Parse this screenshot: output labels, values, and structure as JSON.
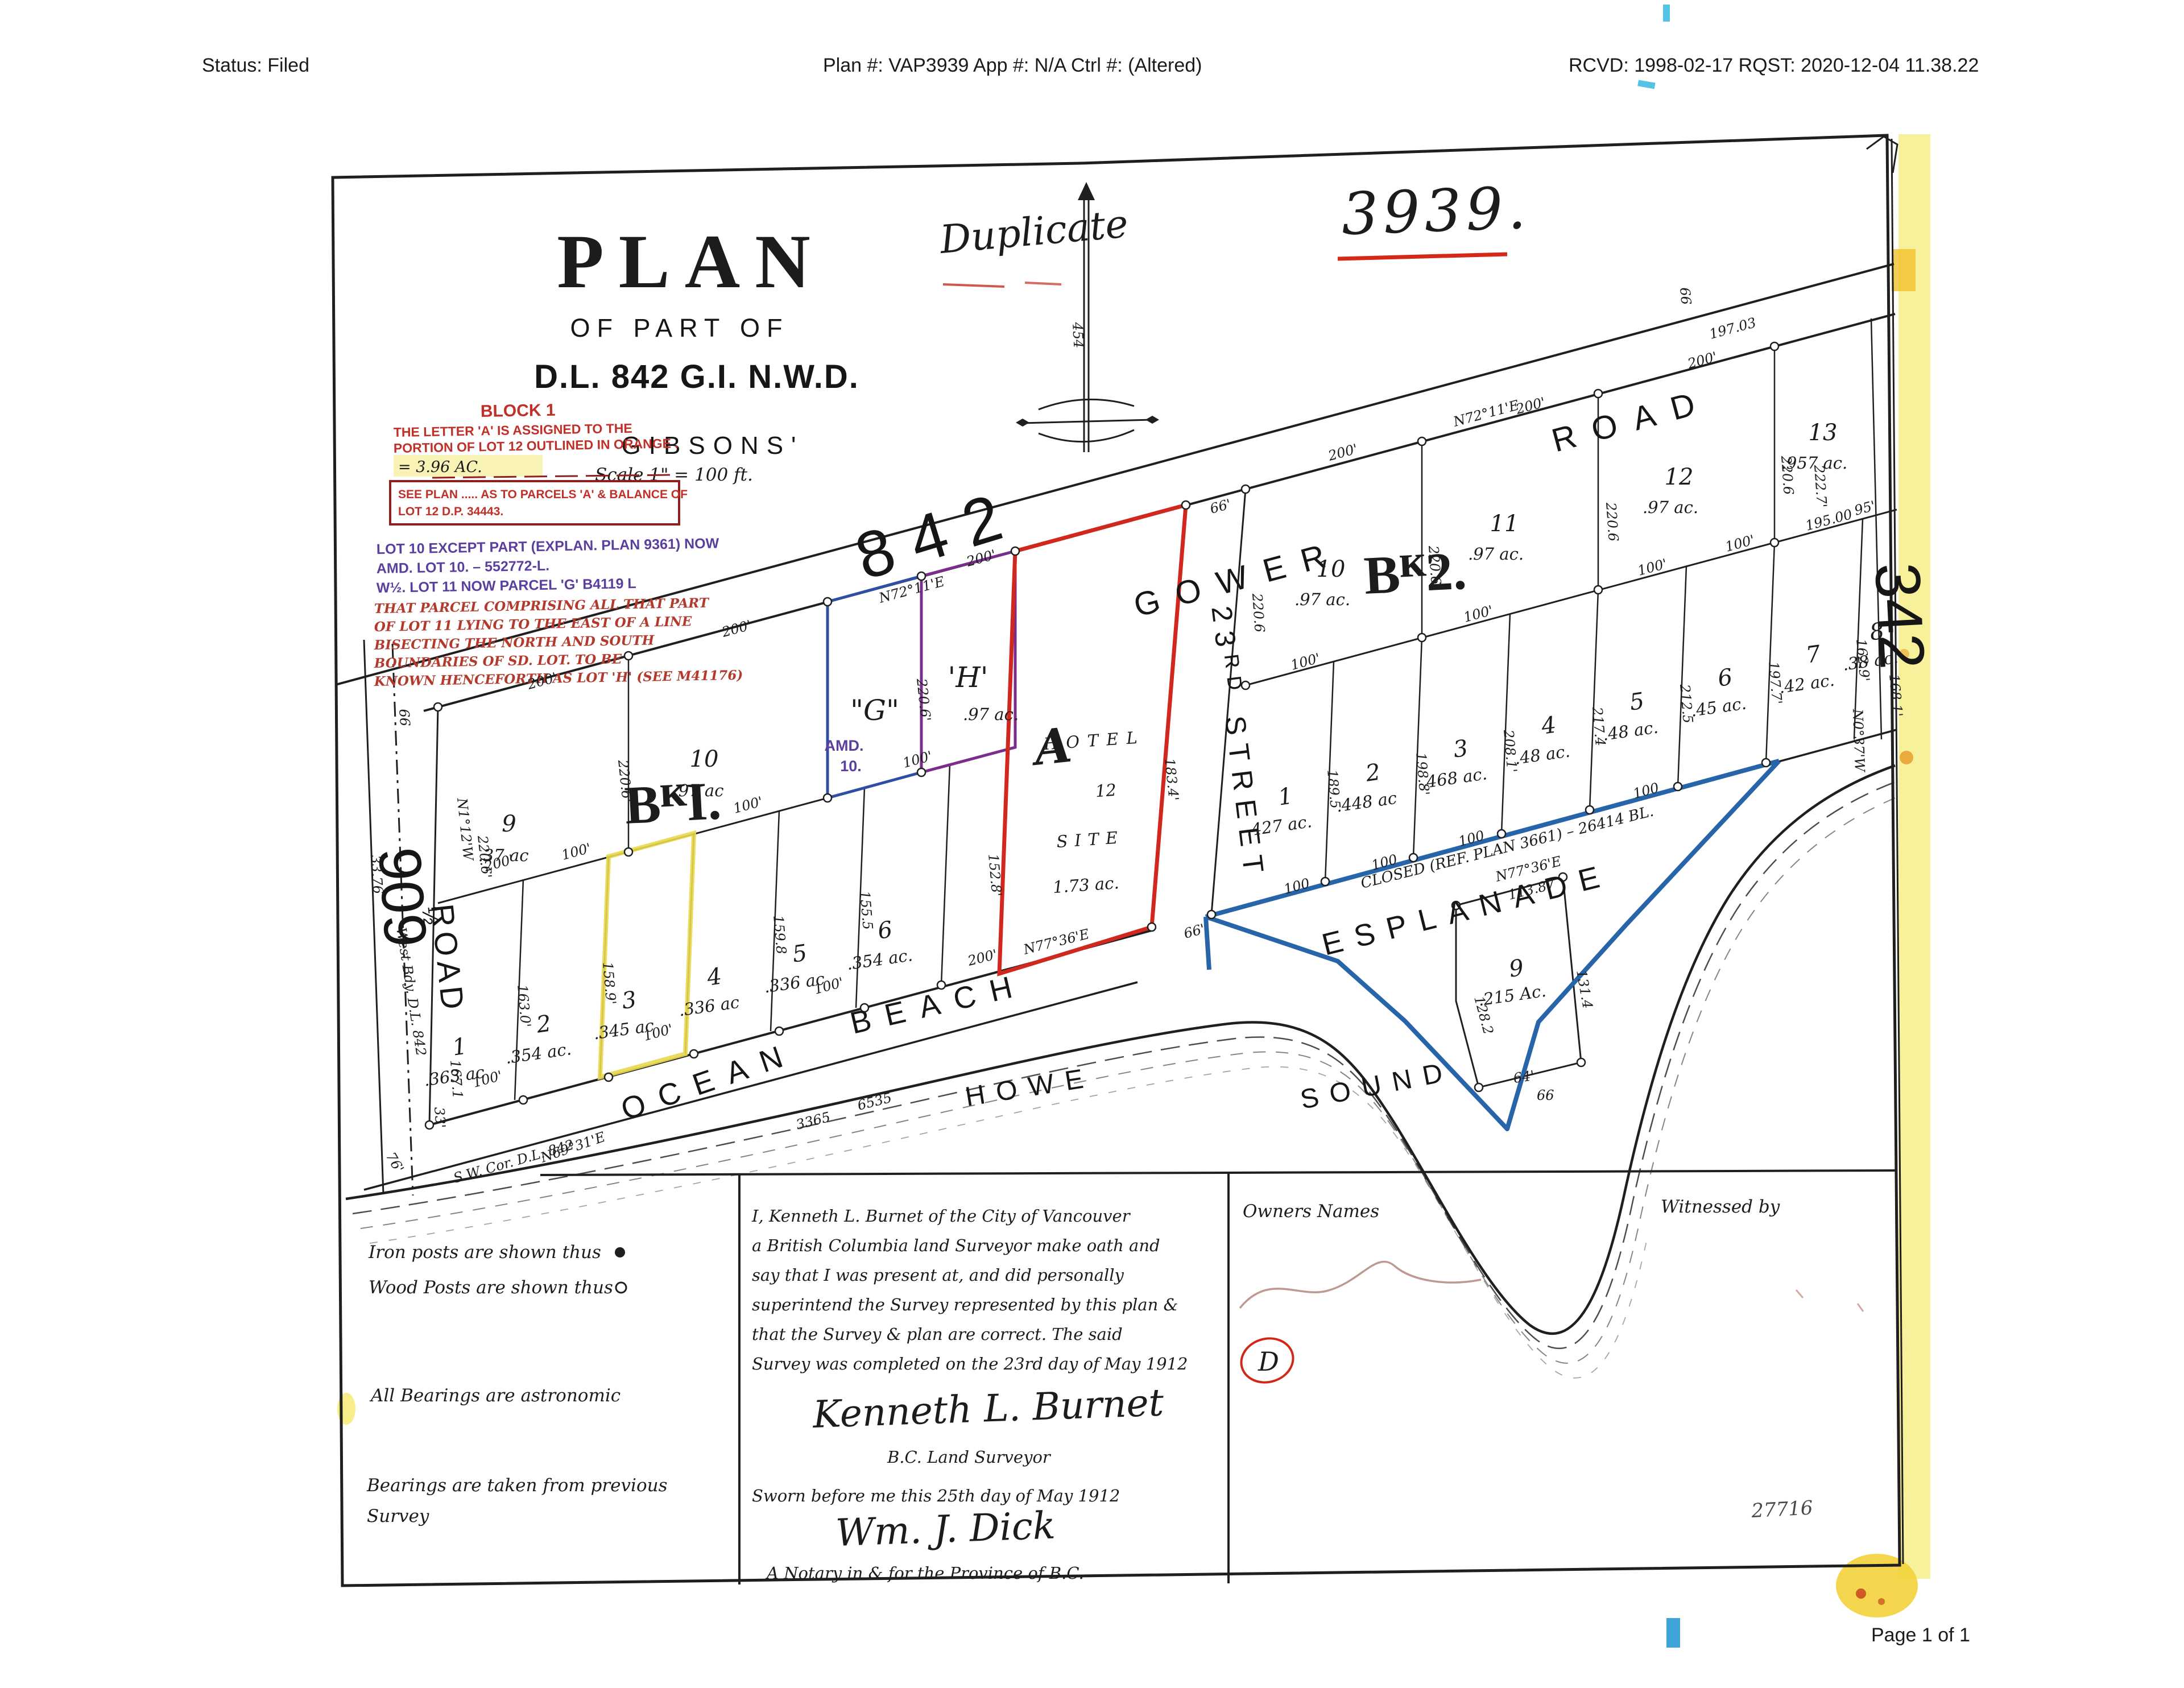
{
  "header": {
    "status": "Status: Filed",
    "plan": "Plan #: VAP3939 App #: N/A Ctrl #:  (Altered)",
    "rcvd": "RCVD: 1998-02-17 RQST: 2020-12-04 11.38.22"
  },
  "footer": {
    "page": "Page 1 of 1"
  },
  "stamps": {
    "duplicate": "Duplicate",
    "number": "3939."
  },
  "title": {
    "main": "PLAN",
    "sub": "OF PART OF",
    "district": "D.L. 842 G.I. N.W.D.",
    "place": "GIBSONS'",
    "scale": "Scale 1\" = 100 ft."
  },
  "annotations": {
    "block1_title": "BLOCK 1",
    "block1_line1": "THE LETTER 'A' IS ASSIGNED TO THE",
    "block1_line2": "PORTION OF LOT 12 OUTLINED IN ORANGE .",
    "highlight_line": "= 3.96 AC.",
    "box_line1": "SEE PLAN ..... AS TO PARCELS 'A' & BALANCE OF",
    "box_line2": "LOT 12     D.P. 34443.",
    "blue_line1": "LOT 10 EXCEPT PART (EXPLAN. PLAN 9361) NOW",
    "blue_line2": "AMD. LOT 10. – 552772-L.",
    "blue_line3": "W½. LOT 11 NOW PARCEL 'G'    B4119 L",
    "red_line1": "THAT PARCEL COMPRISING ALL THAT PART",
    "red_line2": "OF LOT 11 LYING TO THE EAST OF A LINE",
    "red_line3": "BISECTING THE NORTH AND SOUTH",
    "red_line4": "BOUNDARIES OF SD. LOT. TO BE",
    "red_line5": "KNOWN HENCEFORTH AS LOT 'H' (SEE M41176)"
  },
  "plan": {
    "blocks": {
      "b1": "BᴷI.",
      "b2": "Bᴷ2."
    },
    "streets": {
      "gower1": "GOWER",
      "gower2": "ROAD",
      "street23": "23ᴿᴰ STREET",
      "esplanade": "ESPLANADE",
      "ocean": "OCEAN",
      "beach": "BEACH",
      "howe": "HOWE",
      "sound": "SOUND",
      "r909": "909",
      "half": "½",
      "road909": "ROAD",
      "dl842": "842",
      "dl342": "342",
      "westbdy": "West Bdy. D.L. 842",
      "swcor": "S.W. Cor. D.L. 842"
    },
    "g": "\"G\"",
    "h": "'H'",
    "h_area": ".97 ac.",
    "amd1": "AMD.",
    "amd2": "10.",
    "closed_note": "CLOSED (REF. PLAN 3661) – 26414 BL.",
    "hotel": {
      "a": "A",
      "l1": "HOTEL",
      "l2": "12",
      "l3": "SITE",
      "l4": "1.73 ac."
    },
    "lot9w": {
      "num": "9",
      "area": ".215 Ac."
    },
    "b1_north": [
      {
        "num": "9",
        "area": ".37 ac"
      },
      {
        "num": "10",
        "area": ".97 ac"
      }
    ],
    "b1_south": [
      {
        "num": "1",
        "area": ".363 ac"
      },
      {
        "num": "2",
        "area": ".354 ac."
      },
      {
        "num": "3",
        "area": ".345 ac"
      },
      {
        "num": "4",
        "area": ".336 ac"
      },
      {
        "num": "5",
        "area": ".336 ac"
      },
      {
        "num": "6",
        "area": ".354 ac."
      }
    ],
    "b2_north": [
      {
        "num": "10",
        "area": ".97 ac."
      },
      {
        "num": "11",
        "area": ".97 ac."
      },
      {
        "num": "12",
        "area": ".97 ac."
      },
      {
        "num": "13",
        "area": ".957 ac."
      }
    ],
    "b2_south": [
      {
        "num": "1",
        "area": ".427 ac."
      },
      {
        "num": "2",
        "area": ".448 ac"
      },
      {
        "num": "3",
        "area": ".468 ac."
      },
      {
        "num": "4",
        "area": ".48 ac."
      },
      {
        "num": "5",
        "area": ".48 ac."
      },
      {
        "num": "6",
        "area": ".45 ac."
      },
      {
        "num": "7",
        "area": ".42 ac."
      },
      {
        "num": "8",
        "area": ".38 ac."
      }
    ],
    "dims": [
      "200'",
      "200'",
      "N72°11'E",
      "200'",
      "66'",
      "200'",
      "N72°11'E",
      "200'",
      "200'",
      "197.03",
      "66",
      "222.7'",
      "220.6",
      "220.6",
      "220.6",
      "220.6",
      "183.4'",
      "220.6'",
      "220.6'",
      "220.6'",
      "N1°12'W",
      "167.1",
      "33'",
      "100'",
      "100'",
      "200'",
      "100'",
      "163.0'",
      "158.9'",
      "159.8",
      "155.5",
      "152.8'",
      "100'",
      "100'",
      "100'",
      "N69°31'E",
      "3365",
      "6535",
      "N77°36'E",
      "200'",
      "66'",
      "100'",
      "100'",
      "100'",
      "100'",
      "195.00",
      "95'",
      "189.5",
      "198.8'",
      "208.1'",
      "217.4",
      "212.5",
      "197.7'",
      "162.9'",
      "168.1'",
      "100",
      "100",
      "100",
      "100",
      "N77°36'E",
      "113.87",
      "131.4",
      "64'",
      "128.2",
      "66",
      "N0°37'W",
      "33.76",
      "76'",
      "454",
      "66"
    ]
  },
  "legend": {
    "iron": "Iron posts are shown thus",
    "wood": "Wood Posts are shown thus",
    "bearings1": "All Bearings are astronomic",
    "bearings2": "Bearings are taken from previous",
    "bearings3": "Survey"
  },
  "declaration": {
    "line1": "I, Kenneth L. Burnet of the City of Vancouver",
    "line2": "a British Columbia land Surveyor make oath and",
    "line3": "say that I was present at, and did personally",
    "line4": "superintend the Survey represented by this plan &",
    "line5": "that the Survey & plan are correct.  The said",
    "line6": "Survey was completed on the 23rd day of May 1912",
    "signature": "Kenneth L. Burnet",
    "role": "B.C. Land Surveyor",
    "sworn": "Sworn before me this 25th day of May 1912",
    "notary_signature": "Wm. J. Dick",
    "notary_role": "A Notary in & for the Province of B.C."
  },
  "owners": {
    "label": "Owners Names",
    "witnessed": "Witnessed by",
    "mark": "D",
    "faint": "27716"
  }
}
